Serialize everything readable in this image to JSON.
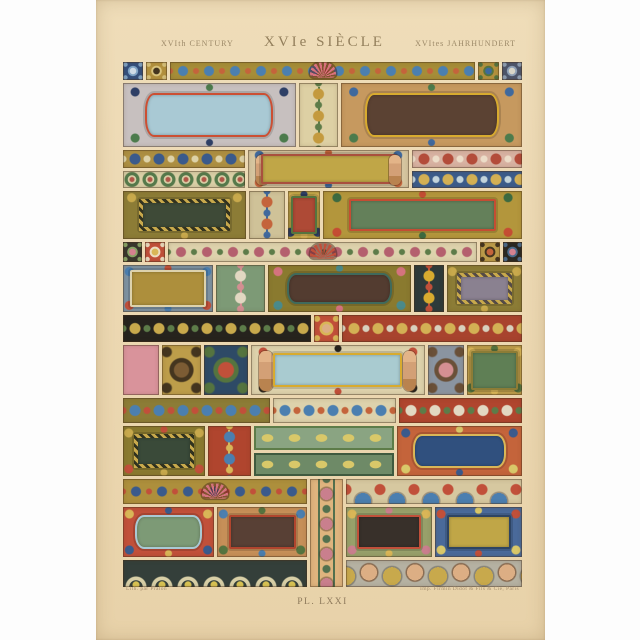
{
  "header": {
    "left": "XVIth CENTURY",
    "center": "XVIe SIÈCLE",
    "right": "XVItes JAHRHUNDERT"
  },
  "footer": {
    "left_credit": "Lith. par Pralon",
    "right_credit": "Imp. Firmin Didot & Fils & Cie, Paris",
    "plate_number": "PL. LXXI"
  },
  "colors": {
    "paper": "#ecd8b2",
    "page_background": "#fdfdfd",
    "caption_text": "#97835f"
  },
  "plate": {
    "rows": [
      {
        "h": 18,
        "tiles": [
          {
            "n": "corner-tile-blue-floral",
            "t": "sq",
            "f": 4.6,
            "bg": "#35507c",
            "a1": "#cfdbe6",
            "a2": "#7fa3c4"
          },
          {
            "n": "corner-tile-gold-rosette",
            "t": "sq",
            "f": 4.8,
            "bg": "#b3913e",
            "a1": "#44351f",
            "a2": "#d9c37c"
          },
          {
            "n": "top-frieze-shell-scrolls",
            "t": "shell",
            "f": 70,
            "bg": "#a68d38",
            "a1": "#4b7fb0",
            "a2": "#c4643b",
            "sh": "#d9717c"
          },
          {
            "n": "corner-tile-gold-cross",
            "t": "sq",
            "f": 4.8,
            "bg": "#b3913e",
            "a1": "#3d6a9d",
            "a2": "#55743f"
          },
          {
            "n": "corner-tile-slate-leaf",
            "t": "sq",
            "f": 4.6,
            "bg": "#4e566b",
            "a1": "#d9d6c8",
            "a2": "#8fa0b5"
          }
        ]
      },
      {
        "h": 64,
        "tiles": [
          {
            "n": "cartouche-red-strap-blue-panel",
            "t": "panel",
            "m": "round",
            "f": 44,
            "bg": "#c7c0bf",
            "fr": "#cc4f33",
            "in": "#a9c9d4",
            "a1": "#2e3f66",
            "a2": "#4c7b4c"
          },
          {
            "n": "scroll-column-gold-serpent",
            "t": "column",
            "f": 10,
            "bg": "#ddd0a4",
            "a1": "#c49a3e",
            "a2": "#5d7c49"
          },
          {
            "n": "cartouche-gold-frame-brown-panel",
            "t": "panel",
            "m": "round",
            "f": 46,
            "bg": "#c6995f",
            "fr": "#d8ab2f",
            "in": "#5b4233",
            "a1": "#3f699d",
            "a2": "#4c7b4c"
          }
        ]
      },
      {
        "h": 38,
        "tiles": [
          {
            "n": "left-frieze-stack",
            "f": 31,
            "stack": [
              {
                "n": "frieze-gold-blue-cross",
                "t": "scroll",
                "h": 1,
                "bg": "#ad8f42",
                "a1": "#3a5a8c",
                "a2": "#ddd2a8"
              },
              {
                "n": "frieze-green-rings",
                "t": "circles",
                "h": 1,
                "bg": "#d9cfa6",
                "a1": "#567a4b",
                "a2": "#b05647"
              }
            ]
          },
          {
            "n": "figural-frieze-nudes-tablet",
            "t": "figures",
            "m": "tight",
            "f": 41,
            "bg": "#d5c5a0",
            "fr": "#a9503e",
            "in": "#c0a647",
            "a1": "#3f699d",
            "a2": "#c4643b"
          },
          {
            "n": "right-frieze-stack",
            "f": 28,
            "stack": [
              {
                "n": "frieze-pink-palmette",
                "t": "scroll",
                "h": 1,
                "bg": "#d8b2a2",
                "a1": "#b34c3a",
                "a2": "#ecdcc8"
              },
              {
                "n": "frieze-blue-acanthus",
                "t": "scroll",
                "h": 1,
                "bg": "#3c5c8a",
                "a1": "#d3b054",
                "a2": "#c2d3da"
              }
            ]
          }
        ]
      },
      {
        "h": 48,
        "tiles": [
          {
            "n": "panel-chevron-dark-green",
            "t": "panel",
            "m": "chev",
            "f": 31,
            "bg": "#8c7c36",
            "fr": "#c8a94c",
            "in": "#3e4a37",
            "a1": "#c8a94c",
            "a2": "#8c7c36"
          },
          {
            "n": "scroll-column-orange-blue",
            "t": "column",
            "f": 9,
            "bg": "#cfc298",
            "a1": "#c4643b",
            "a2": "#3f699d"
          },
          {
            "n": "niche-figure-on-red",
            "t": "panel",
            "m": "tight",
            "f": 8,
            "bg": "#c0a647",
            "fr": "#55743f",
            "in": "#ae4a36",
            "a1": "#d3b054",
            "a2": "#2e3f66"
          },
          {
            "n": "panel-green-red-strapwork",
            "t": "panel",
            "f": 50,
            "bg": "#b3963c",
            "fr": "#c44d33",
            "in": "#64805a",
            "a1": "#3d6a40",
            "a2": "#c44d33"
          }
        ]
      },
      {
        "h": 20,
        "tiles": [
          {
            "n": "tile-dark-flower",
            "t": "sq",
            "f": 4.6,
            "bg": "#39372d",
            "a1": "#d4818f",
            "a2": "#88a465"
          },
          {
            "n": "tile-red-urn",
            "t": "sq",
            "f": 5,
            "bg": "#c1503a",
            "a1": "#d9b657",
            "a2": "#ecdcc0"
          },
          {
            "n": "frieze-flower-garland-basket",
            "t": "shell",
            "f": 76,
            "bg": "#ddd2ac",
            "a1": "#b4606e",
            "a2": "#5d7c49",
            "sh": "#c1503a"
          },
          {
            "n": "tile-gold-fruit",
            "t": "sq",
            "f": 5,
            "bg": "#bd9d4a",
            "a1": "#c4643b",
            "a2": "#44351f"
          },
          {
            "n": "tile-black-rosette",
            "t": "sq",
            "f": 4.6,
            "bg": "#2b2822",
            "a1": "#d4818f",
            "a2": "#4a6a8a"
          }
        ]
      },
      {
        "h": 47,
        "tiles": [
          {
            "n": "panel-gold-scallop-border",
            "t": "panel",
            "m": "tight",
            "f": 24,
            "bg": "#7d92a2",
            "fr": "#ddd2ac",
            "in": "#ad8f3c",
            "a1": "#4b7fb0",
            "a2": "#c1503a"
          },
          {
            "n": "acanthus-column-green",
            "t": "column",
            "f": 13,
            "bg": "#7d9a76",
            "a1": "#e2d8c2",
            "a2": "#d48f92"
          },
          {
            "n": "cartouche-olive-pink-scrolls",
            "t": "panel",
            "m": "round",
            "f": 38,
            "bg": "#8a7a2f",
            "fr": "#3f6a5c",
            "in": "#533c30",
            "a1": "#d4737e",
            "a2": "#4a8a8a"
          },
          {
            "n": "strip-gold-coil-dark",
            "t": "column",
            "f": 8,
            "bg": "#2e3a3a",
            "a1": "#d8ab2f",
            "a2": "#c1503a"
          },
          {
            "n": "panel-chevron-mauve",
            "t": "panel",
            "m": "chev",
            "f": 20,
            "bg": "#8c7c36",
            "fr": "#c8a94c",
            "in": "#8a8190",
            "a1": "#c8a94c",
            "a2": "#8c7c36"
          }
        ]
      },
      {
        "h": 27,
        "tiles": [
          {
            "n": "frieze-black-gold-scrolls",
            "t": "scroll",
            "f": 47,
            "bg": "#26231d",
            "a1": "#c8a94c",
            "a2": "#5d7c49"
          },
          {
            "n": "tile-cherub-on-red",
            "t": "sq",
            "f": 6,
            "bg": "#c1503a",
            "a1": "#dcae84",
            "a2": "#d9b657"
          },
          {
            "n": "frieze-red-gold-scrolls",
            "t": "scroll",
            "f": 45,
            "bg": "#a8432e",
            "a1": "#d3b054",
            "a2": "#d8d0bd"
          }
        ]
      },
      {
        "h": 50,
        "tiles": [
          {
            "n": "tile-pink-plain",
            "t": "plain",
            "f": 9,
            "bg": "#d9939b"
          },
          {
            "n": "tile-gold-mask",
            "t": "sq",
            "f": 10,
            "bg": "#bd9d4a",
            "a1": "#7c5c34",
            "a2": "#44351f"
          },
          {
            "n": "tile-blue-cherry",
            "t": "sq",
            "f": 11,
            "bg": "#2e4a66",
            "a1": "#c1503a",
            "a2": "#55743f"
          },
          {
            "n": "cartouche-herm-figures-blue-panel",
            "t": "figures",
            "f": 44,
            "bg": "#ddd2ac",
            "fr": "#d8ab2f",
            "in": "#a9cbd0",
            "a1": "#c1503a",
            "a2": "#26231d"
          },
          {
            "n": "tile-figure-pink-ribbon",
            "t": "sq",
            "f": 9,
            "bg": "#8a94a0",
            "a1": "#d48f92",
            "a2": "#6a5038"
          },
          {
            "n": "panel-green-leaf-frame",
            "t": "panel",
            "m": "tight",
            "f": 14,
            "bg": "#bd9d4a",
            "fr": "#8c7c36",
            "in": "#5f7f55",
            "a1": "#d9b657",
            "a2": "#55743f"
          }
        ]
      },
      {
        "h": 25,
        "tiles": [
          {
            "n": "frieze-olive-cornucopia",
            "t": "scroll",
            "f": 37,
            "bg": "#8c7c36",
            "a1": "#4b7fb0",
            "a2": "#c1503a"
          },
          {
            "n": "frieze-blue-dolphins-mask",
            "t": "scroll",
            "f": 31,
            "bg": "#ddd2ac",
            "a1": "#4b7fb0",
            "a2": "#c4643b"
          },
          {
            "n": "frieze-red-white-scrolls",
            "t": "scroll",
            "f": 31,
            "bg": "#b0452e",
            "a1": "#e2d8c2",
            "a2": "#5d7c49"
          }
        ]
      },
      {
        "h": 50,
        "tiles": [
          {
            "n": "panel-laurel-dark-green",
            "t": "panel",
            "m": "chev",
            "f": 21,
            "bg": "#8a7a2f",
            "fr": "#c8a94c",
            "in": "#3a4a39",
            "a1": "#c8a94c",
            "a2": "#c1503a"
          },
          {
            "n": "ornament-lion-strapwork",
            "t": "column",
            "f": 11,
            "bg": "#b0452e",
            "a1": "#4b7fb0",
            "a2": "#d9b657"
          },
          {
            "n": "monogram-frieze-stack",
            "f": 36,
            "stack": [
              {
                "n": "frieze-monogram-upper",
                "t": "monogram",
                "h": 1,
                "bg": "#8aa482",
                "a1": "#d9c869",
                "a2": "#5d7c49"
              },
              {
                "n": "frieze-monogram-lower",
                "t": "monogram",
                "h": 1,
                "bg": "#6e8a67",
                "a1": "#d9c869",
                "a2": "#3f5a3f"
              }
            ]
          },
          {
            "n": "cartouche-blue-panel-red-strap",
            "t": "panel",
            "m": "round",
            "f": 32,
            "bg": "#c4643b",
            "fr": "#d9b657",
            "in": "#30507e",
            "a1": "#3a5a8c",
            "a2": "#d9c869"
          }
        ]
      },
      {
        "h": 108,
        "tiles": [
          {
            "n": "bottom-left-stack",
            "f": 46,
            "stack": [
              {
                "n": "frieze-shell-scroll-left",
                "t": "shell",
                "h": 25,
                "bg": "#ad8f3c",
                "a1": "#3a5a8c",
                "a2": "#c1503a",
                "sh": "#d4737e"
              },
              {
                "n": "bottom-left-cartouches",
                "f": 50,
                "row": [
                  {
                    "n": "cartouche-green-blue-strap",
                    "t": "panel",
                    "m": "round",
                    "f": 1,
                    "bg": "#c1503a",
                    "fr": "#a9c9d4",
                    "in": "#7d9a76",
                    "a1": "#d9b657",
                    "a2": "#3a5a8c"
                  },
                  {
                    "n": "cartouche-brown-red-frame",
                    "t": "panel",
                    "f": 1,
                    "bg": "#c68f58",
                    "fr": "#b0452e",
                    "in": "#584035",
                    "a1": "#4b7fb0",
                    "a2": "#55743f"
                  }
                ]
              },
              {
                "n": "frieze-arches-dark",
                "t": "arches",
                "h": 27,
                "bg": "#343f3a",
                "a1": "#d8cfa6",
                "a2": "#d9c353"
              }
            ]
          },
          {
            "n": "vertical-strapwork-strip",
            "t": "vstrip",
            "f": 8,
            "bg": "#dfb47e",
            "a1": "#c97f8d",
            "a2": "#53704e"
          },
          {
            "n": "bottom-right-stack",
            "f": 44,
            "stack": [
              {
                "n": "frieze-blue-shells",
                "t": "fans",
                "h": 25,
                "bg": "#d6c8a0",
                "a1": "#4b7fb0",
                "a2": "#c1503a"
              },
              {
                "n": "bottom-right-cartouches",
                "f": 50,
                "row": [
                  {
                    "n": "cartouche-dark-panel-masks",
                    "t": "panel",
                    "f": 1,
                    "bg": "#98a06a",
                    "fr": "#c1503a",
                    "in": "#38302a",
                    "a1": "#d9b657",
                    "a2": "#c97f8d"
                  },
                  {
                    "n": "cartouche-gold-panel-blue-frame",
                    "t": "panel",
                    "f": 1,
                    "bg": "#4a6a9a",
                    "fr": "#2e4462",
                    "in": "#c0a647",
                    "a1": "#c1503a",
                    "a2": "#d9c869"
                  }
                ]
              },
              {
                "n": "frieze-cherubs-shells",
                "t": "cherubs",
                "h": 27,
                "bg": "#b5b1a2",
                "a1": "#c8a94c",
                "a2": "#dcae84"
              }
            ]
          }
        ]
      }
    ]
  }
}
